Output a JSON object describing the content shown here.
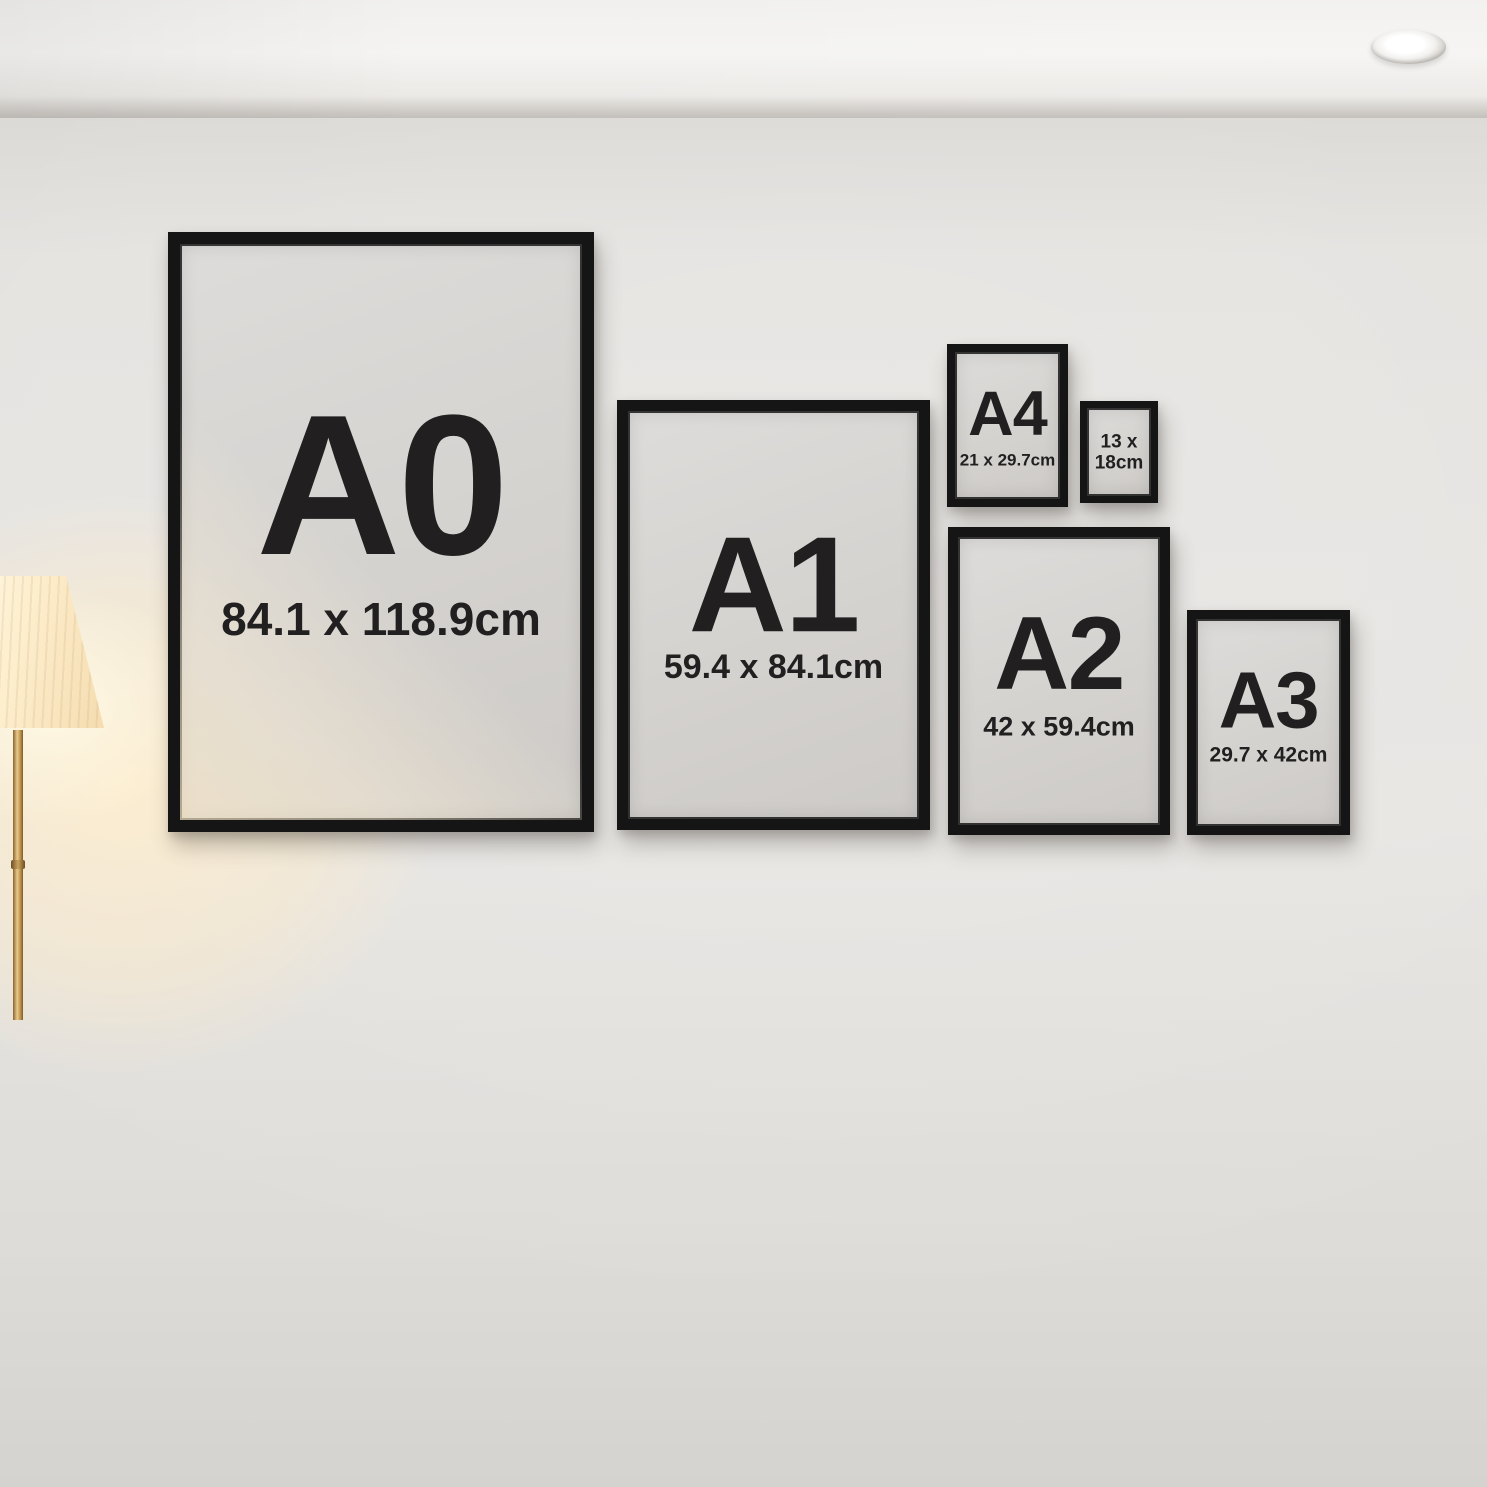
{
  "frames": [
    {
      "id": "A0",
      "label": "A0",
      "dims": "84.1 x 118.9cm"
    },
    {
      "id": "A1",
      "label": "A1",
      "dims": "59.4 x 84.1cm"
    },
    {
      "id": "A4",
      "label": "A4",
      "dims": "21 x 29.7cm"
    },
    {
      "id": "13x18",
      "line1": "13 x",
      "line2": "18cm"
    },
    {
      "id": "A2",
      "label": "A2",
      "dims": "42 x 59.4cm"
    },
    {
      "id": "A3",
      "label": "A3",
      "dims": "29.7 x 42cm"
    }
  ],
  "colors": {
    "frame_black": "#151515",
    "mat_gray": "#d6d4d1",
    "label_text": "#211f20",
    "wall": "#e5e3e0",
    "ceiling": "#f3f2ef",
    "sofa_fabric": "#6f7280",
    "rug": "#b2aba0",
    "wood_floor": "#3a241c",
    "lamp_glow": "#ffe9c3",
    "lamp_shade": "#fdf0d2",
    "brass": "#c49a58"
  }
}
